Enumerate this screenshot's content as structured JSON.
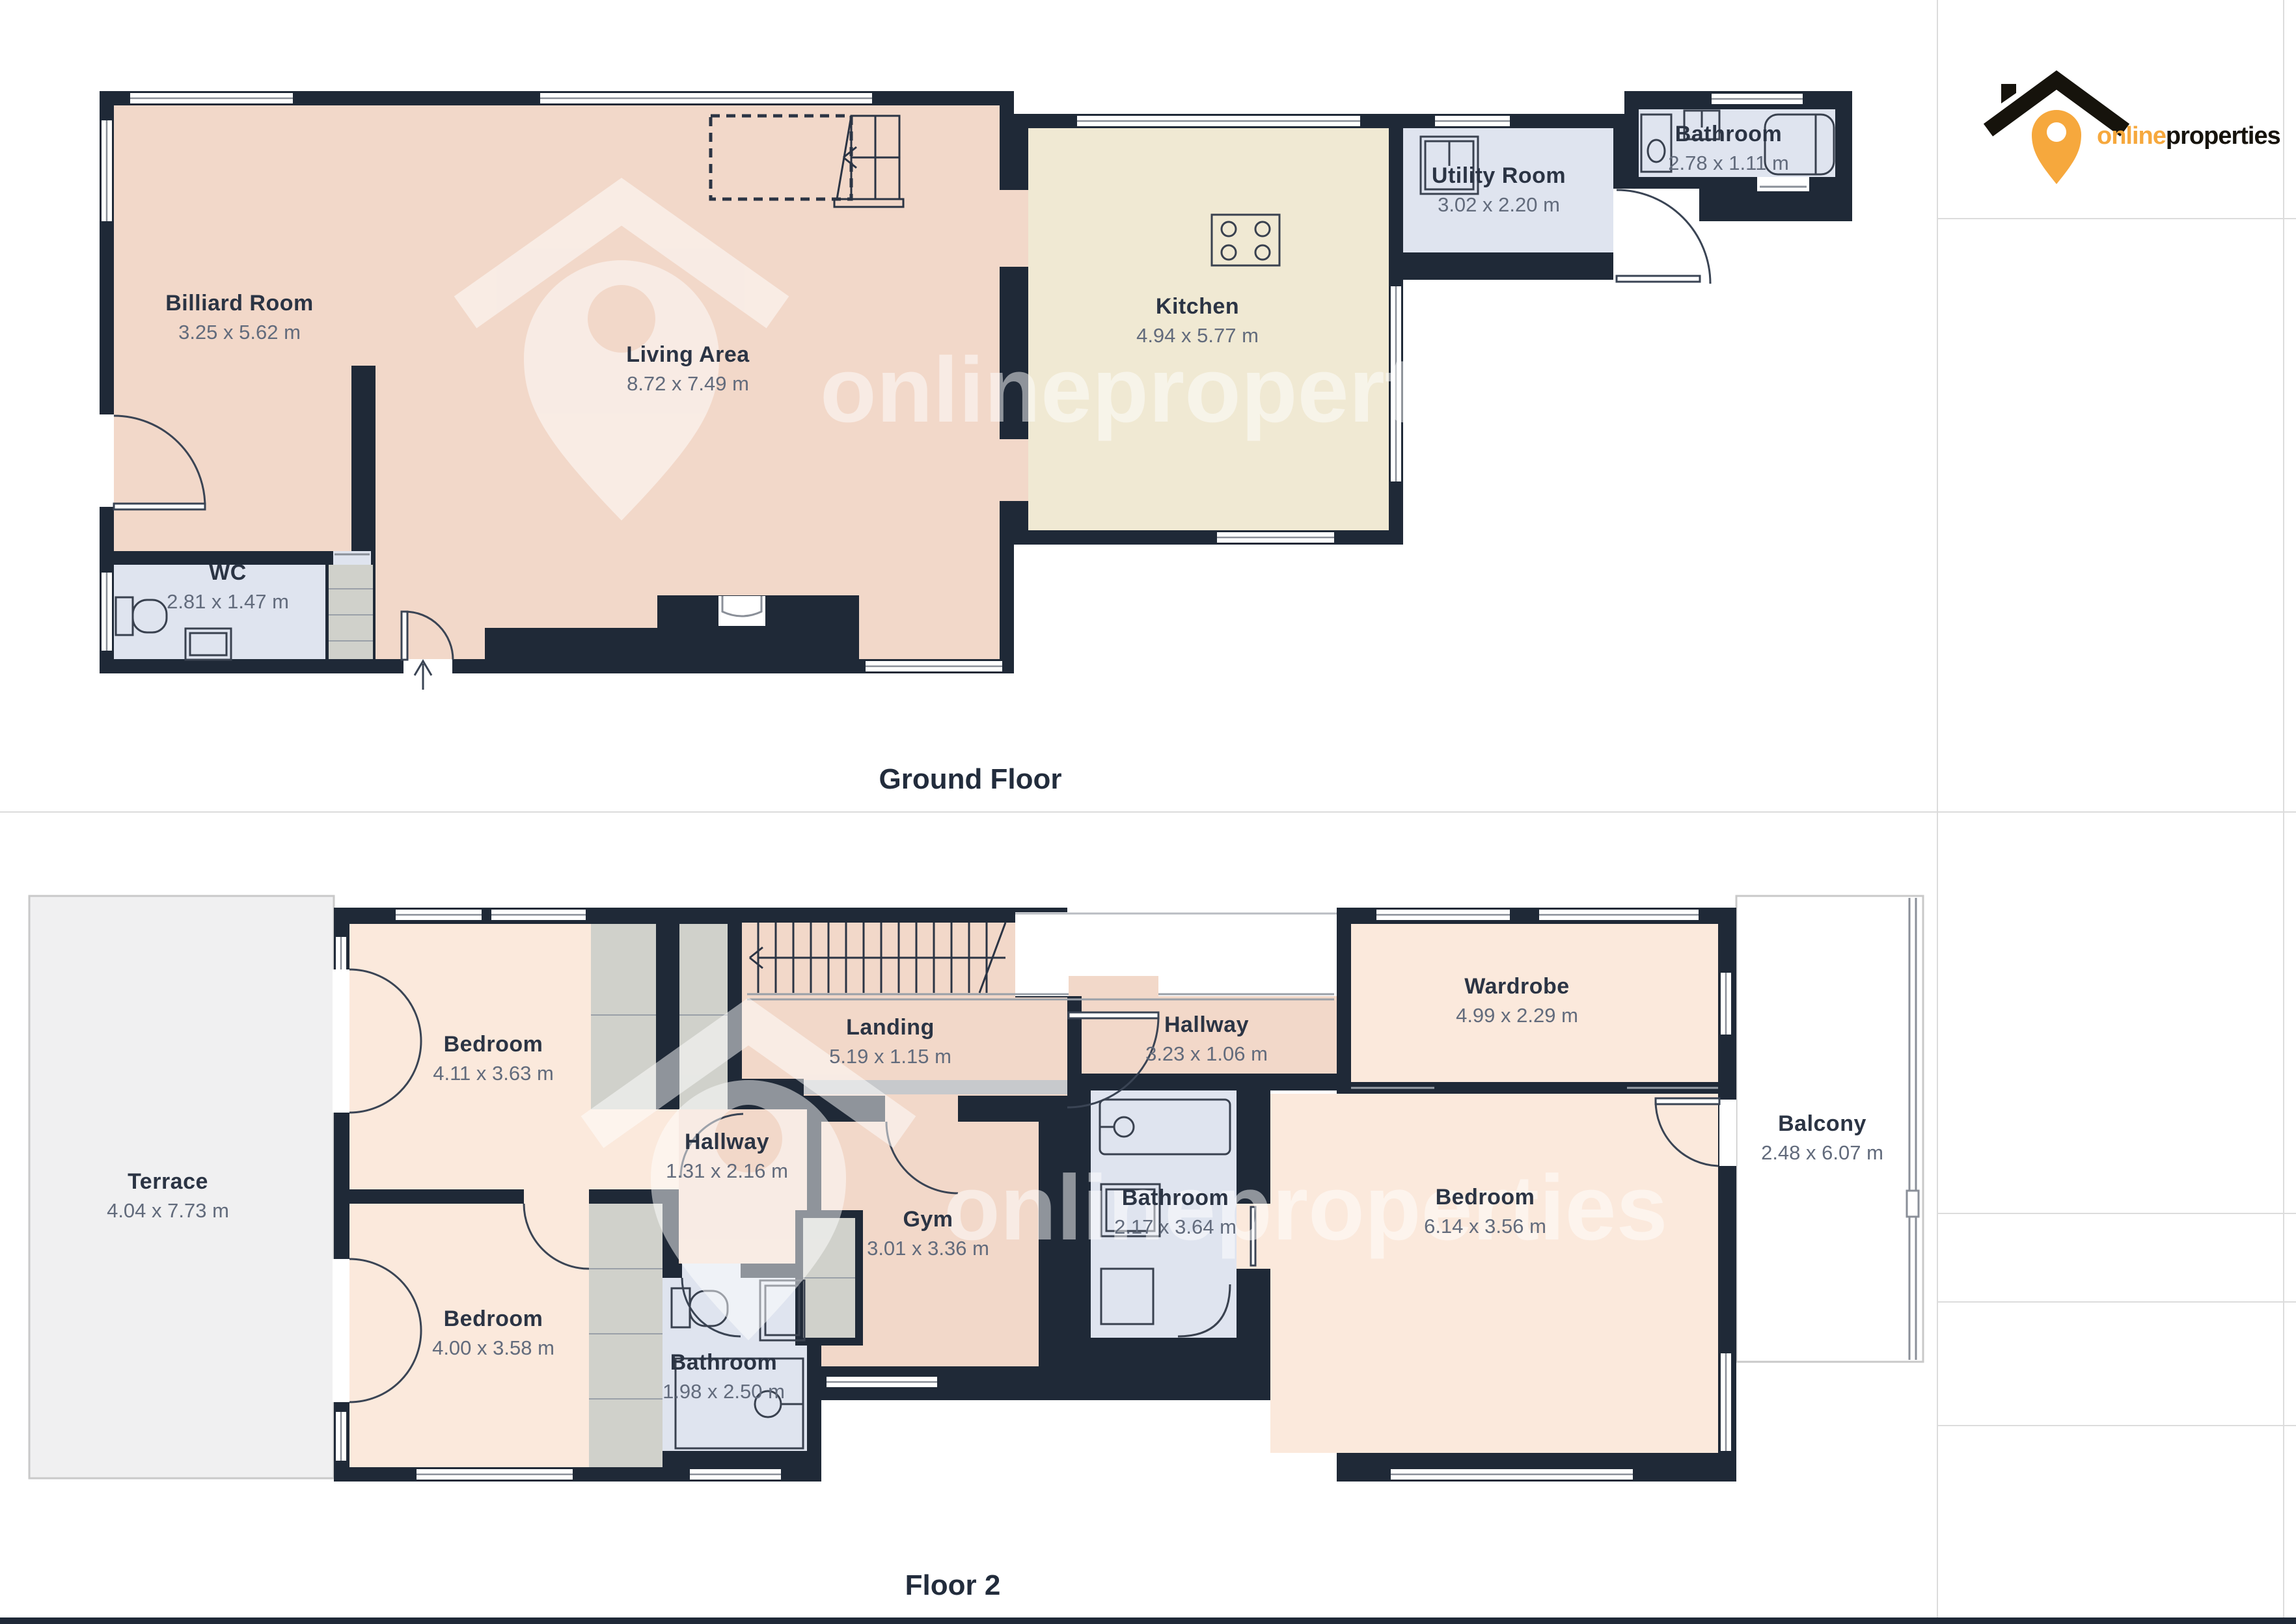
{
  "branding": {
    "watermark_text": "onlineproperties",
    "logo_text_orange": "online",
    "logo_text_dark": "properties"
  },
  "palette": {
    "wall": "#1f2937",
    "room_peach": "#f2d8c9",
    "room_peach_light": "#fbe9dc",
    "room_cream": "#f0e9d3",
    "room_blue": "#dfe4ef",
    "closet_gray": "#d0d1cb",
    "terrace_gray": "#f0f0f1",
    "label_navy": "#2b3444",
    "label_dim_gray": "#626b7c",
    "logo_orange": "#f6a83d",
    "logo_black": "#16130c"
  },
  "ground_floor": {
    "title": "Ground Floor",
    "rooms": [
      {
        "id": "billiard",
        "name": "Billiard Room",
        "dims": "3.25 x 5.62 m"
      },
      {
        "id": "living",
        "name": "Living Area",
        "dims": "8.72 x 7.49 m"
      },
      {
        "id": "kitchen",
        "name": "Kitchen",
        "dims": "4.94 x 5.77 m"
      },
      {
        "id": "utility",
        "name": "Utility Room",
        "dims": "3.02 x 2.20 m"
      },
      {
        "id": "bathroom",
        "name": "Bathroom",
        "dims": "2.78 x 1.11 m"
      },
      {
        "id": "wc",
        "name": "WC",
        "dims": "2.81 x 1.47 m"
      }
    ]
  },
  "floor_2": {
    "title": "Floor 2",
    "rooms": [
      {
        "id": "terrace",
        "name": "Terrace",
        "dims": "4.04 x 7.73 m"
      },
      {
        "id": "bedroom_top_left",
        "name": "Bedroom",
        "dims": "4.11 x 3.63 m"
      },
      {
        "id": "landing",
        "name": "Landing",
        "dims": "5.19 x 1.15 m"
      },
      {
        "id": "hallway_upper",
        "name": "Hallway",
        "dims": "3.23 x 1.06 m"
      },
      {
        "id": "wardrobe",
        "name": "Wardrobe",
        "dims": "4.99 x 2.29 m"
      },
      {
        "id": "hallway_inner",
        "name": "Hallway",
        "dims": "1.31 x 2.16 m"
      },
      {
        "id": "gym",
        "name": "Gym",
        "dims": "3.01 x 3.36 m"
      },
      {
        "id": "bathroom_mid",
        "name": "Bathroom",
        "dims": "2.17 x 3.64 m"
      },
      {
        "id": "bedroom_right",
        "name": "Bedroom",
        "dims": "6.14 x 3.56 m"
      },
      {
        "id": "balcony",
        "name": "Balcony",
        "dims": "2.48 x 6.07 m"
      },
      {
        "id": "bedroom_bottom_left",
        "name": "Bedroom",
        "dims": "4.00 x 3.58 m"
      },
      {
        "id": "bathroom_bottom",
        "name": "Bathroom",
        "dims": "1.98 x 2.50 m"
      }
    ]
  }
}
